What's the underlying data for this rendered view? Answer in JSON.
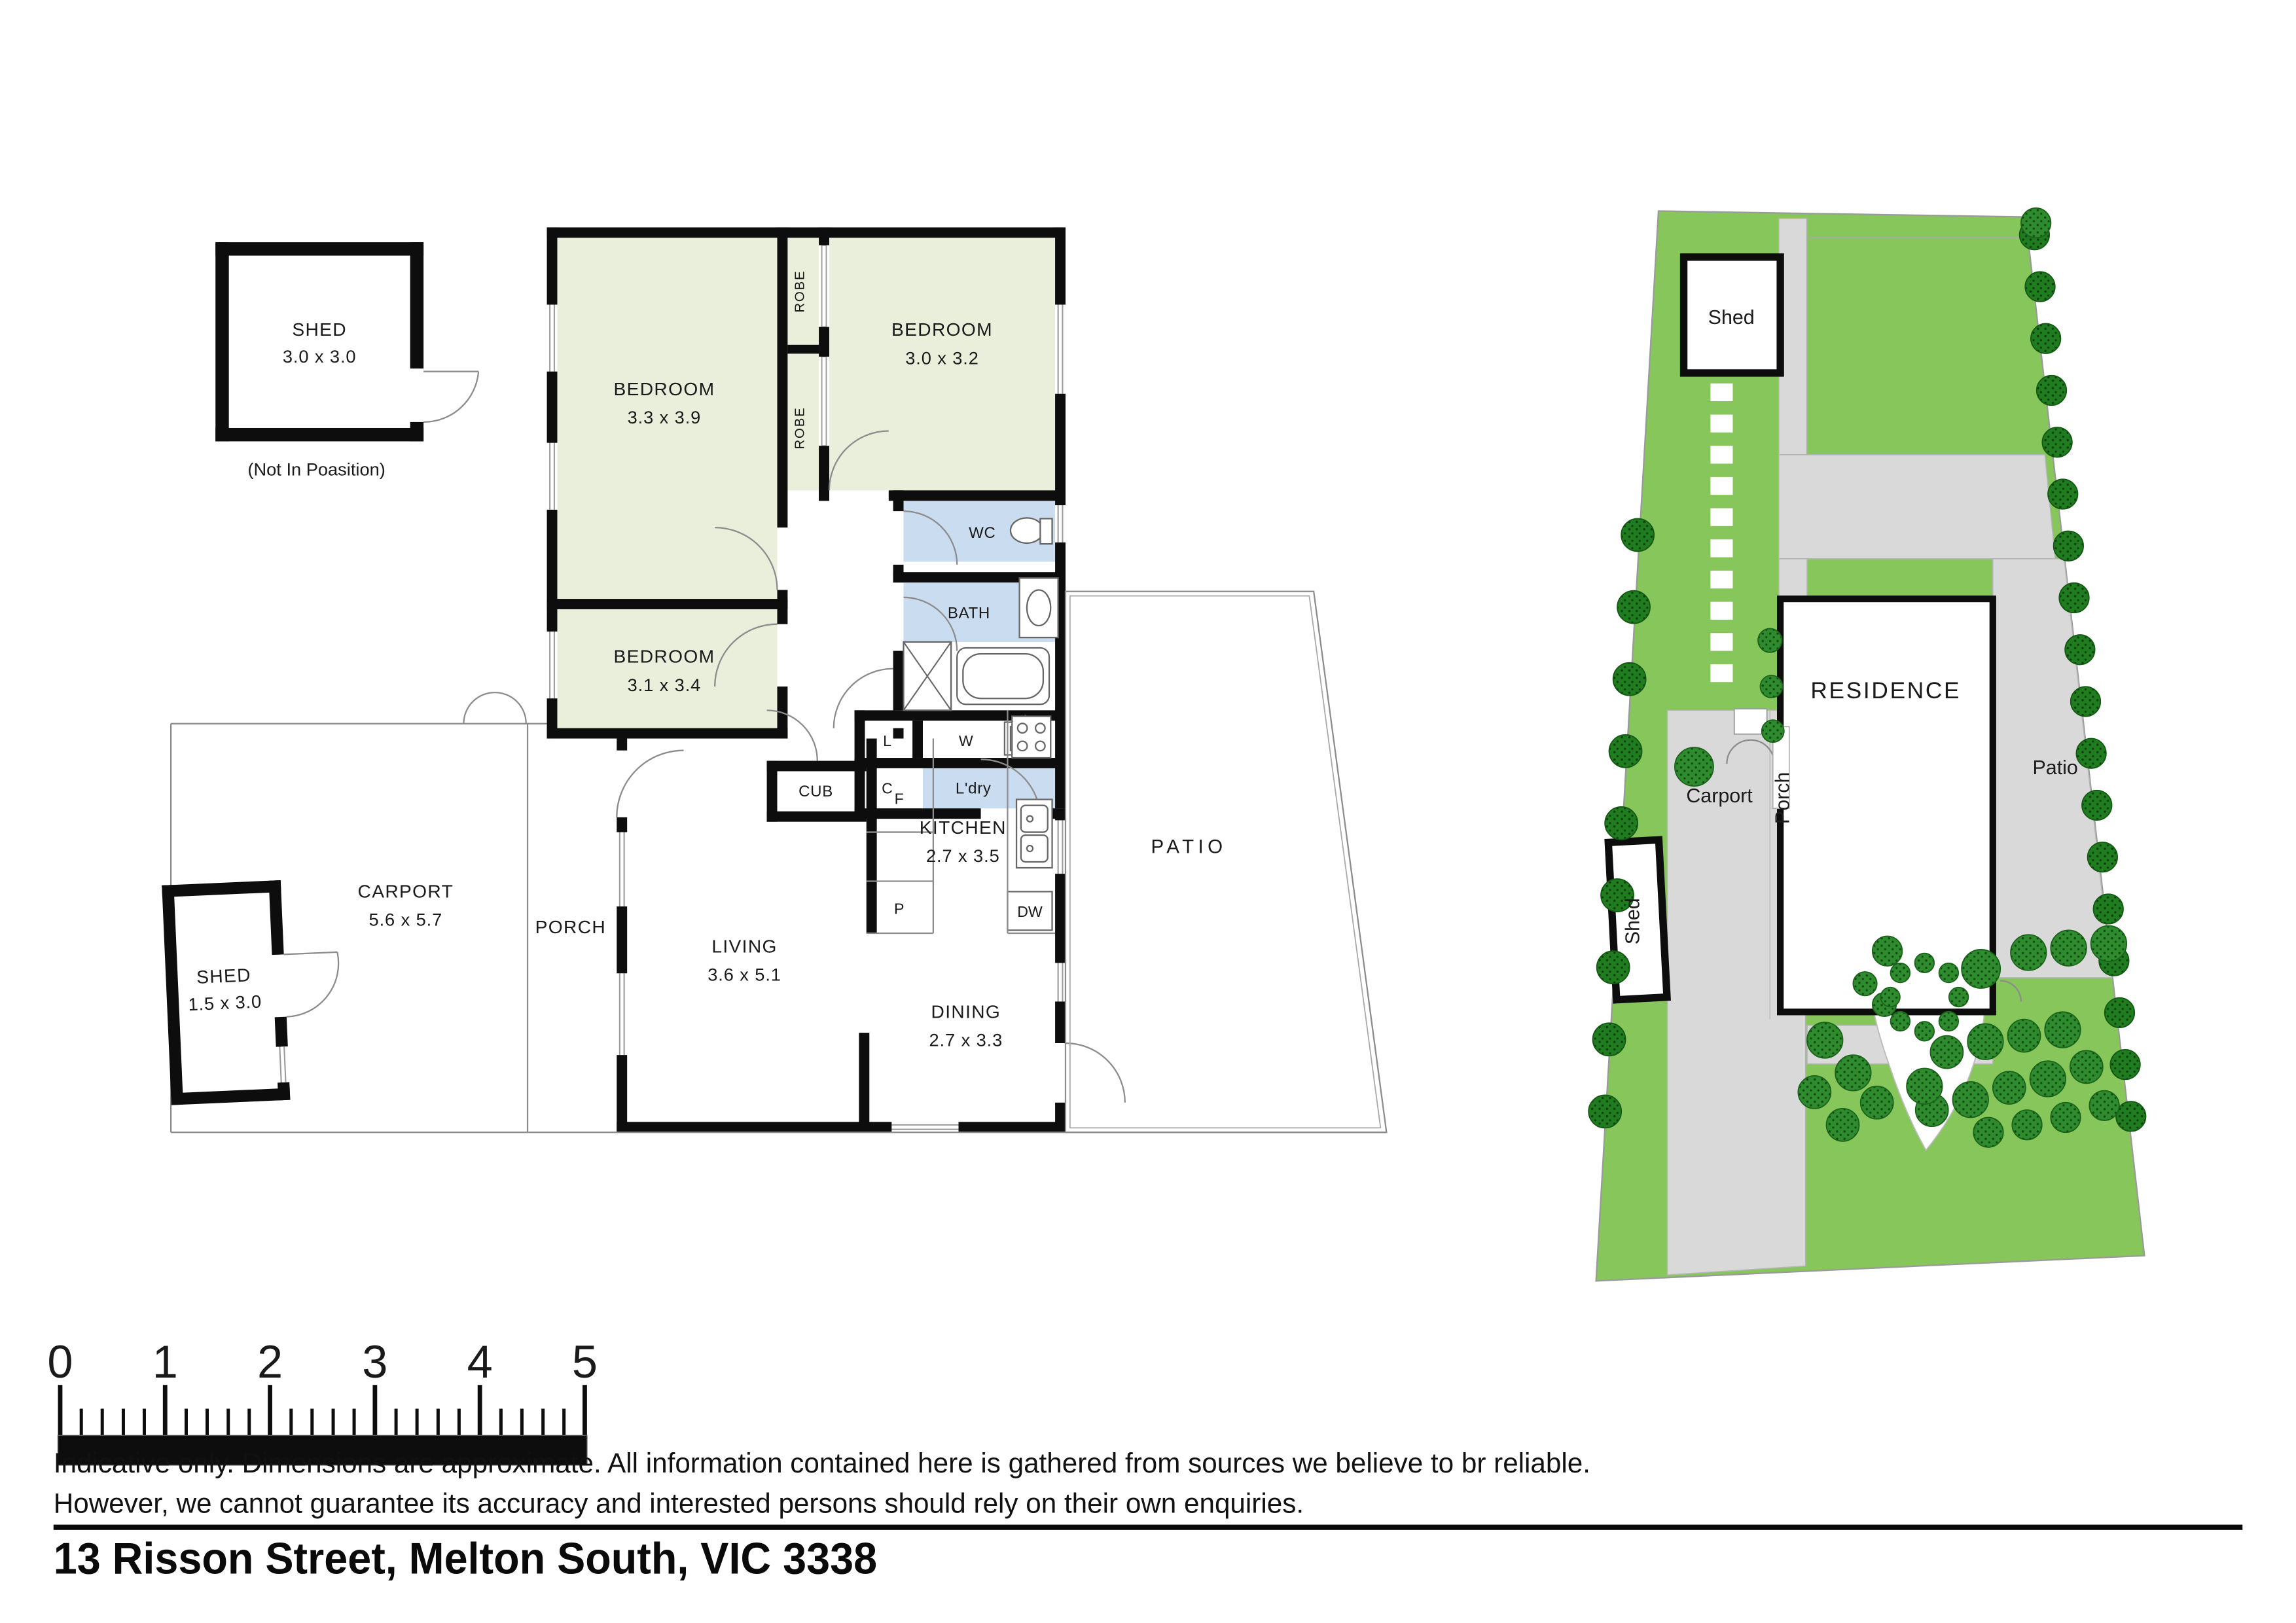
{
  "floorplan": {
    "shed_detached": {
      "name": "SHED",
      "dims": "3.0 x 3.0",
      "note": "(Not In Poasition)"
    },
    "bedroom1": {
      "name": "BEDROOM",
      "dims": "3.3 x 3.9"
    },
    "bedroom2": {
      "name": "BEDROOM",
      "dims": "3.0 x 3.2"
    },
    "bedroom3": {
      "name": "BEDROOM",
      "dims": "3.1 x 3.4"
    },
    "robe1": "ROBE",
    "robe2": "ROBE",
    "wc": "WC",
    "bath": "BATH",
    "laundry": "L'dry",
    "linen": "L",
    "cupboard": "C",
    "washer": "W",
    "cub": "CUB",
    "fridge": "F",
    "pantry": "P",
    "dishwasher": "DW",
    "kitchen": {
      "name": "KITCHEN",
      "dims": "2.7 x 3.5"
    },
    "living": {
      "name": "LIVING",
      "dims": "3.6 x 5.1"
    },
    "dining": {
      "name": "DINING",
      "dims": "2.7 x 3.3"
    },
    "porch": "PORCH",
    "carport": {
      "name": "CARPORT",
      "dims": "5.6 x 5.7"
    },
    "shed_small": {
      "name": "SHED",
      "dims": "1.5 x 3.0"
    },
    "patio": "PATIO"
  },
  "siteplan": {
    "shed_back": "Shed",
    "residence": "RESIDENCE",
    "carport": "Carport",
    "porch": "Porch",
    "patio": "Patio",
    "shed_side": "Shed"
  },
  "scalebar": {
    "ticks": [
      "0",
      "1",
      "2",
      "3",
      "4",
      "5"
    ]
  },
  "disclaimer": {
    "line1": "Indicative only. Dimensions are approximate. All information contained here is gathered from sources we believe to br reliable.",
    "line2": "However, we cannot guarantee its accuracy and interested persons should rely on their own enquiries."
  },
  "address": "13 Risson Street, Melton South, VIC 3338",
  "colors": {
    "room_green": "#e9efdb",
    "wet_blue": "#cadcf0",
    "lawn_green": "#86c65a",
    "tree_green": "#2e8b2e",
    "tree_dark": "#1f7d1f",
    "paving_gray": "#d9d9d9",
    "wall_black": "#0d0d0d"
  }
}
